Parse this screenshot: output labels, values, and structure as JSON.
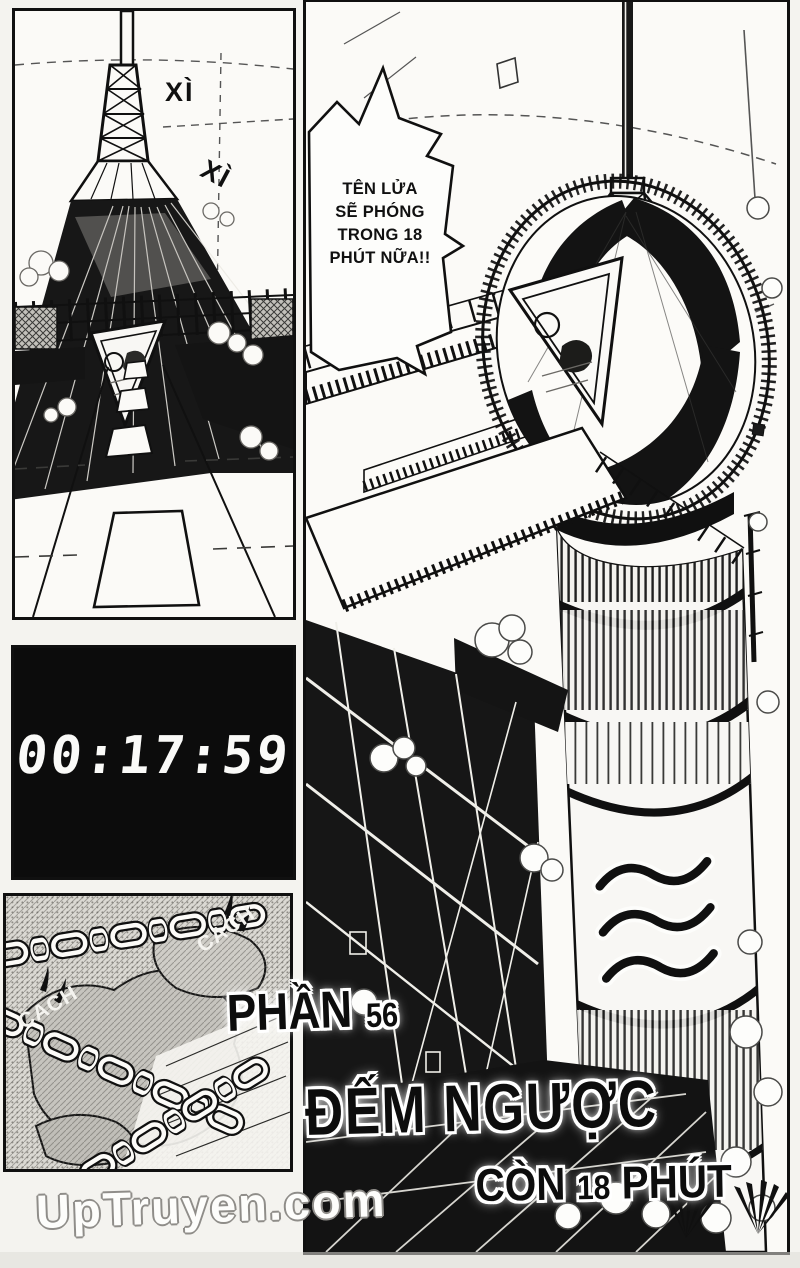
{
  "page": {
    "title_part_prefix": "PHẦN",
    "title_part_number": "56",
    "title_main": "ĐẾM NGƯỢC",
    "title_sub_prefix": "CÒN",
    "title_sub_number": "18",
    "title_sub_suffix": "PHÚT",
    "watermark": "UpTruyen.com"
  },
  "panels": {
    "tower": {
      "sfx_1": "XÌ",
      "sfx_2": "XÌ"
    },
    "countdown_clock": {
      "time": "00:17:59"
    },
    "chains": {
      "sfx_1": "CACH",
      "sfx_2": "CACH"
    },
    "rocket": {
      "speech_bubble": {
        "line_1": "TÊN LỬA",
        "line_2": "SẼ PHÓNG",
        "line_3": "TRONG 18",
        "line_4": "PHÚT NỮA!!"
      }
    }
  },
  "colors": {
    "ink": "#101010",
    "paper": "#f6f5f1",
    "halftone": "#c9c7c2"
  }
}
